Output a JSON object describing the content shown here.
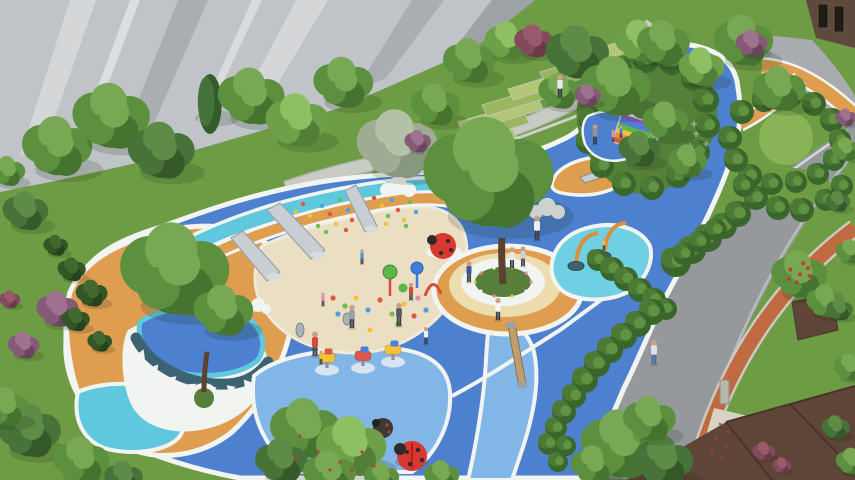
{
  "meta": {
    "title": "Residential children's playground — aerial landscape rendering",
    "alt": "Aerial 3D rendering of a residential playground: organic blue rubber surfacing with a beige sand pit, three steel slides on a climbing slope with colorful holds, a central tree plaza ringed by a white bench and orange pad, cyan water-play pool with orange arched water cannons, rainbow climbing ramp, spring riders, ladybug sculptures, terraced lawns, hedge gardens with a circular lawn, gray high-rise facades top-left, and a diagonal road with an orange jogging track and brown townhouses at the right"
  },
  "palette": {
    "lawn": "#6e9c45",
    "lawnLight": "#88b356",
    "lawnShade": "#55803a",
    "terraceA": "#b2c678",
    "terraceB": "#9ab65e",
    "blue": "#4d81cf",
    "blueLight": "#82b6e6",
    "cyan": "#5fc8de",
    "pondCyan": "#6fd0e4",
    "white": "#f2f4f2",
    "sand": "#eadfc3",
    "sandEdge": "#f0ead9",
    "orange": "#df9d4f",
    "cream": "#ecdcae",
    "teal": "#3c6371",
    "road": "#96999c",
    "roadLight": "#a9acae",
    "curb": "#d6d8d6",
    "stone": "#c9cbc5",
    "stoneDark": "#b4b6b1",
    "track": "#bf6a40",
    "trackCasing": "#cdc9c2",
    "building": "#c0c3c7",
    "buildingDark": "#aaadb2",
    "buildingDarker": "#9da2a7",
    "panelLight": "#d4d6d8",
    "roofBrown": "#5f4537",
    "brownDark": "#47352b",
    "facade": "#5e4a3c",
    "windowDark": "#221c16",
    "steel": "#c9ced2",
    "steelDark": "#9aa1a7",
    "wood": "#bd9f6e",
    "woodDark": "#8d6f49",
    "ladybugRed": "#d8382f",
    "dark": "#2b2b2b",
    "cannonOrange": "#d8903a",
    "bucket": "#3f6470",
    "walkway": "#d9d3c4",
    "pillar": "#b9b6ae",
    "flowerGreen": "#577f3a",
    "trunk": "#5b4230",
    "skin": "#c9a083"
  },
  "scene": {
    "dot_colors": [
      "#e05545",
      "#f2c238",
      "#6abf4d",
      "#4d9fe0",
      "#e886b8"
    ],
    "climb_dots": [
      [
        303,
        204,
        0
      ],
      [
        310,
        216,
        1
      ],
      [
        318,
        226,
        2
      ],
      [
        322,
        206,
        3
      ],
      [
        330,
        214,
        0
      ],
      [
        336,
        224,
        1
      ],
      [
        340,
        200,
        2
      ],
      [
        348,
        210,
        3
      ],
      [
        352,
        220,
        0
      ],
      [
        358,
        202,
        1
      ],
      [
        364,
        212,
        2
      ],
      [
        370,
        222,
        3
      ],
      [
        374,
        198,
        0
      ],
      [
        382,
        206,
        1
      ],
      [
        388,
        216,
        2
      ],
      [
        392,
        200,
        3
      ],
      [
        398,
        210,
        0
      ],
      [
        404,
        220,
        1
      ],
      [
        410,
        202,
        2
      ],
      [
        416,
        212,
        3
      ],
      [
        300,
        226,
        1
      ],
      [
        326,
        232,
        2
      ],
      [
        346,
        230,
        0
      ],
      [
        366,
        228,
        3
      ],
      [
        386,
        224,
        1
      ],
      [
        406,
        226,
        2
      ],
      [
        286,
        222,
        0
      ],
      [
        292,
        232,
        3
      ],
      [
        296,
        212,
        1
      ]
    ],
    "sand_toys": [
      [
        333,
        298,
        0
      ],
      [
        345,
        306,
        2
      ],
      [
        356,
        298,
        1
      ],
      [
        368,
        310,
        3
      ],
      [
        380,
        300,
        0
      ],
      [
        392,
        314,
        2
      ],
      [
        404,
        304,
        1
      ],
      [
        352,
        320,
        4
      ],
      [
        338,
        314,
        3
      ],
      [
        414,
        316,
        0
      ],
      [
        398,
        324,
        2
      ],
      [
        370,
        330,
        1
      ],
      [
        426,
        310,
        3
      ],
      [
        418,
        298,
        4
      ]
    ],
    "teeth": [
      [
        140,
        352,
        -35
      ],
      [
        154,
        366,
        -20
      ],
      [
        172,
        377,
        -10
      ],
      [
        192,
        384,
        -3
      ],
      [
        212,
        387,
        3
      ],
      [
        231,
        386,
        10
      ],
      [
        248,
        381,
        20
      ],
      [
        262,
        372,
        32
      ]
    ],
    "flowers": [
      [
        531,
        282,
        "#e884b0"
      ],
      [
        526,
        291,
        "#f2f2f2"
      ],
      [
        512,
        296,
        "#e8c84a"
      ],
      [
        494,
        296,
        "#e884b0"
      ],
      [
        481,
        291,
        "#f2f2f2"
      ],
      [
        475,
        282,
        "#e8c84a"
      ],
      [
        481,
        273,
        "#e884b0"
      ],
      [
        494,
        268,
        "#f2f2f2"
      ],
      [
        512,
        268,
        "#e8c84a"
      ],
      [
        526,
        273,
        "#e884b0"
      ]
    ],
    "crosses": [
      [
        696,
        134
      ],
      [
        706,
        144
      ],
      [
        690,
        146
      ],
      [
        700,
        156
      ],
      [
        694,
        124
      ]
    ],
    "walkway_dots": [
      [
        720,
        424
      ],
      [
        728,
        432
      ],
      [
        716,
        438
      ],
      [
        726,
        446
      ],
      [
        712,
        450
      ],
      [
        722,
        458
      ]
    ],
    "red_flower_dots": [
      [
        300,
        436
      ],
      [
        318,
        452
      ],
      [
        340,
        462
      ],
      [
        362,
        452
      ],
      [
        296,
        458
      ],
      [
        330,
        470
      ],
      [
        352,
        470
      ],
      [
        374,
        466
      ]
    ],
    "riders": [
      [
        327,
        368,
        "#f2c238",
        "#e05545"
      ],
      [
        363,
        366,
        "#e05545",
        "#4d7ede"
      ],
      [
        393,
        360,
        "#f2c238",
        "#4d7ede"
      ]
    ],
    "rainbow": {
      "x": 616,
      "y": 118,
      "w": 42,
      "h": 5,
      "rot": 18,
      "cx": 634,
      "cy": 133,
      "colors": [
        "#8a5bbf",
        "#4d7ede",
        "#5cb648",
        "#f2c238",
        "#ef8a3a",
        "#e05545"
      ]
    },
    "people": [
      [
        537,
        240,
        1,
        "#eef0f2"
      ],
      [
        560,
        97,
        0.9,
        "#e8eaec"
      ],
      [
        315,
        356,
        1,
        "#d84b3a"
      ],
      [
        321,
        364,
        0.55,
        "#f2c238"
      ],
      [
        352,
        328,
        0.95,
        "#9aa0a6"
      ],
      [
        399,
        326,
        0.95,
        "#565b60"
      ],
      [
        411,
        300,
        0.7,
        "#d84b3a"
      ],
      [
        426,
        344,
        0.7,
        "#eef0f2"
      ],
      [
        469,
        282,
        0.85,
        "#3d5a9e"
      ],
      [
        512,
        268,
        0.85,
        "#e8eaec"
      ],
      [
        523,
        266,
        0.8,
        "#c9cfd4"
      ],
      [
        498,
        320,
        0.9,
        "#f4f6f7"
      ],
      [
        654,
        364,
        1,
        "#dde3e8",
        "#4a6da8"
      ],
      [
        595,
        144,
        0.8,
        "#8e9398"
      ],
      [
        613,
        142,
        0.5,
        "#e88ab8"
      ],
      [
        621,
        138,
        0.5,
        "#4d7ede"
      ],
      [
        323,
        306,
        0.55,
        "#e88ab8"
      ],
      [
        362,
        264,
        0.6,
        "#4d9fe0"
      ],
      [
        604,
        250,
        0.5,
        "#f2c238"
      ]
    ],
    "trees": [
      [
        58,
        148,
        40,
        "g"
      ],
      [
        112,
        118,
        44,
        "g"
      ],
      [
        162,
        152,
        38,
        "d"
      ],
      [
        210,
        104,
        26,
        "c"
      ],
      [
        252,
        98,
        38,
        "g"
      ],
      [
        298,
        122,
        36,
        "l"
      ],
      [
        344,
        84,
        34,
        "g"
      ],
      [
        398,
        146,
        46,
        "y"
      ],
      [
        436,
        106,
        28,
        "g"
      ],
      [
        470,
        62,
        30,
        "g"
      ],
      [
        508,
        42,
        26,
        "l"
      ],
      [
        534,
        42,
        22,
        "r"
      ],
      [
        418,
        142,
        15,
        "p"
      ],
      [
        26,
        212,
        26,
        "d"
      ],
      [
        8,
        172,
        20,
        "g"
      ],
      [
        176,
        272,
        62,
        "g"
      ],
      [
        224,
        312,
        34,
        "g"
      ],
      [
        490,
        176,
        74,
        "g"
      ],
      [
        578,
        54,
        36,
        "d"
      ],
      [
        616,
        88,
        40,
        "g"
      ],
      [
        560,
        92,
        24,
        "g"
      ],
      [
        640,
        42,
        28,
        "l"
      ],
      [
        640,
        150,
        24,
        "d"
      ],
      [
        666,
        122,
        26,
        "g"
      ],
      [
        688,
        162,
        22,
        "g"
      ],
      [
        588,
        96,
        15,
        "p"
      ],
      [
        664,
        44,
        30,
        "g"
      ],
      [
        702,
        68,
        26,
        "l"
      ],
      [
        744,
        42,
        34,
        "g"
      ],
      [
        780,
        90,
        30,
        "g"
      ],
      [
        752,
        44,
        18,
        "p"
      ],
      [
        800,
        276,
        32,
        "b"
      ],
      [
        826,
        302,
        22,
        "g"
      ],
      [
        622,
        446,
        46,
        "g"
      ],
      [
        664,
        462,
        34,
        "d"
      ],
      [
        594,
        466,
        26,
        "g"
      ],
      [
        650,
        420,
        30,
        "g"
      ],
      [
        306,
        430,
        40,
        "g"
      ],
      [
        352,
        448,
        40,
        "l"
      ],
      [
        282,
        462,
        30,
        "d"
      ],
      [
        330,
        474,
        30,
        "g"
      ],
      [
        382,
        478,
        20,
        "g"
      ],
      [
        442,
        476,
        20,
        "g"
      ],
      [
        30,
        432,
        36,
        "d"
      ],
      [
        82,
        462,
        32,
        "g"
      ],
      [
        6,
        408,
        26,
        "g"
      ],
      [
        124,
        478,
        22,
        "d"
      ],
      [
        58,
        310,
        24,
        "p"
      ],
      [
        24,
        346,
        18,
        "p"
      ],
      [
        10,
        300,
        12,
        "r"
      ],
      [
        72,
        270,
        16,
        "s"
      ],
      [
        92,
        294,
        18,
        "s"
      ],
      [
        76,
        320,
        16,
        "s"
      ],
      [
        56,
        246,
        14,
        "s"
      ],
      [
        100,
        342,
        14,
        "s"
      ],
      [
        846,
        150,
        16,
        "g"
      ],
      [
        838,
        202,
        14,
        "d"
      ],
      [
        850,
        252,
        16,
        "g"
      ],
      [
        840,
        310,
        15,
        "d"
      ],
      [
        850,
        368,
        18,
        "g"
      ],
      [
        836,
        428,
        16,
        "d"
      ],
      [
        852,
        462,
        18,
        "g"
      ],
      [
        764,
        452,
        13,
        "r"
      ],
      [
        782,
        466,
        11,
        "r"
      ],
      [
        846,
        118,
        12,
        "p"
      ]
    ],
    "hedges": [
      [
        598,
        260,
        11
      ],
      [
        612,
        269,
        12
      ],
      [
        626,
        279,
        12
      ],
      [
        640,
        290,
        12
      ],
      [
        654,
        300,
        12
      ],
      [
        666,
        309,
        11
      ],
      [
        652,
        312,
        13
      ],
      [
        638,
        324,
        13
      ],
      [
        624,
        336,
        13
      ],
      [
        610,
        350,
        13
      ],
      [
        597,
        364,
        13
      ],
      [
        585,
        380,
        13
      ],
      [
        574,
        396,
        12
      ],
      [
        564,
        412,
        12
      ],
      [
        556,
        428,
        11
      ],
      [
        549,
        444,
        11
      ],
      [
        566,
        446,
        10
      ],
      [
        558,
        462,
        10
      ],
      [
        676,
        262,
        15
      ],
      [
        692,
        250,
        14
      ],
      [
        708,
        238,
        14
      ],
      [
        724,
        226,
        13
      ],
      [
        738,
        214,
        13
      ],
      [
        684,
        254,
        11
      ],
      [
        700,
        242,
        11
      ],
      [
        716,
        230,
        11
      ],
      [
        592,
        120,
        13
      ],
      [
        600,
        92,
        13
      ],
      [
        620,
        72,
        13
      ],
      [
        646,
        60,
        13
      ],
      [
        672,
        62,
        13
      ],
      [
        694,
        78,
        13
      ],
      [
        706,
        100,
        13
      ],
      [
        708,
        126,
        12
      ],
      [
        698,
        152,
        12
      ],
      [
        678,
        176,
        12
      ],
      [
        652,
        188,
        12
      ],
      [
        624,
        184,
        12
      ],
      [
        602,
        166,
        12
      ],
      [
        588,
        142,
        12
      ],
      [
        742,
        112,
        12
      ],
      [
        764,
        100,
        12
      ],
      [
        790,
        96,
        12
      ],
      [
        814,
        104,
        12
      ],
      [
        832,
        120,
        12
      ],
      [
        840,
        140,
        11
      ],
      [
        834,
        160,
        11
      ],
      [
        818,
        174,
        11
      ],
      [
        796,
        182,
        11
      ],
      [
        772,
        184,
        11
      ],
      [
        750,
        176,
        12
      ],
      [
        736,
        160,
        12
      ],
      [
        730,
        138,
        12
      ],
      [
        756,
        198,
        12
      ],
      [
        778,
        208,
        12
      ],
      [
        802,
        210,
        12
      ],
      [
        826,
        200,
        11
      ],
      [
        842,
        186,
        11
      ],
      [
        744,
        186,
        11
      ]
    ]
  }
}
